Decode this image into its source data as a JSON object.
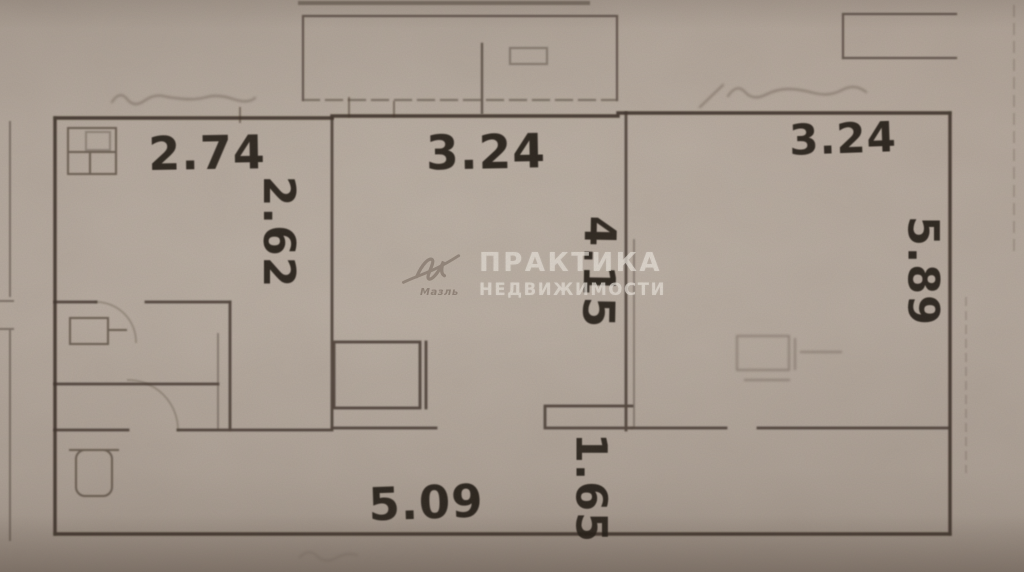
{
  "watermark": {
    "logo_caption": "Мазль",
    "line1": "ПРАКТИКА",
    "line2": "НЕДВИЖИМОСТИ"
  },
  "dimension_labels": [
    {
      "id": "left-room-width",
      "value": "2.74",
      "orientation": "horizontal"
    },
    {
      "id": "left-room-depth",
      "value": "2.62",
      "orientation": "vertical"
    },
    {
      "id": "center-room-width",
      "value": "3.24",
      "orientation": "horizontal"
    },
    {
      "id": "center-room-depth",
      "value": "4.15",
      "orientation": "vertical"
    },
    {
      "id": "right-room-width",
      "value": "3.24",
      "orientation": "horizontal"
    },
    {
      "id": "right-room-depth",
      "value": "5.89",
      "orientation": "vertical"
    },
    {
      "id": "hall-width",
      "value": "5.09",
      "orientation": "horizontal"
    },
    {
      "id": "hall-depth",
      "value": "1.65",
      "orientation": "vertical"
    }
  ],
  "colors": {
    "paper": "#b2a69b",
    "wall_line": "#362c24",
    "label_text": "#1e1812",
    "watermark_text": "#e8e1d9"
  }
}
